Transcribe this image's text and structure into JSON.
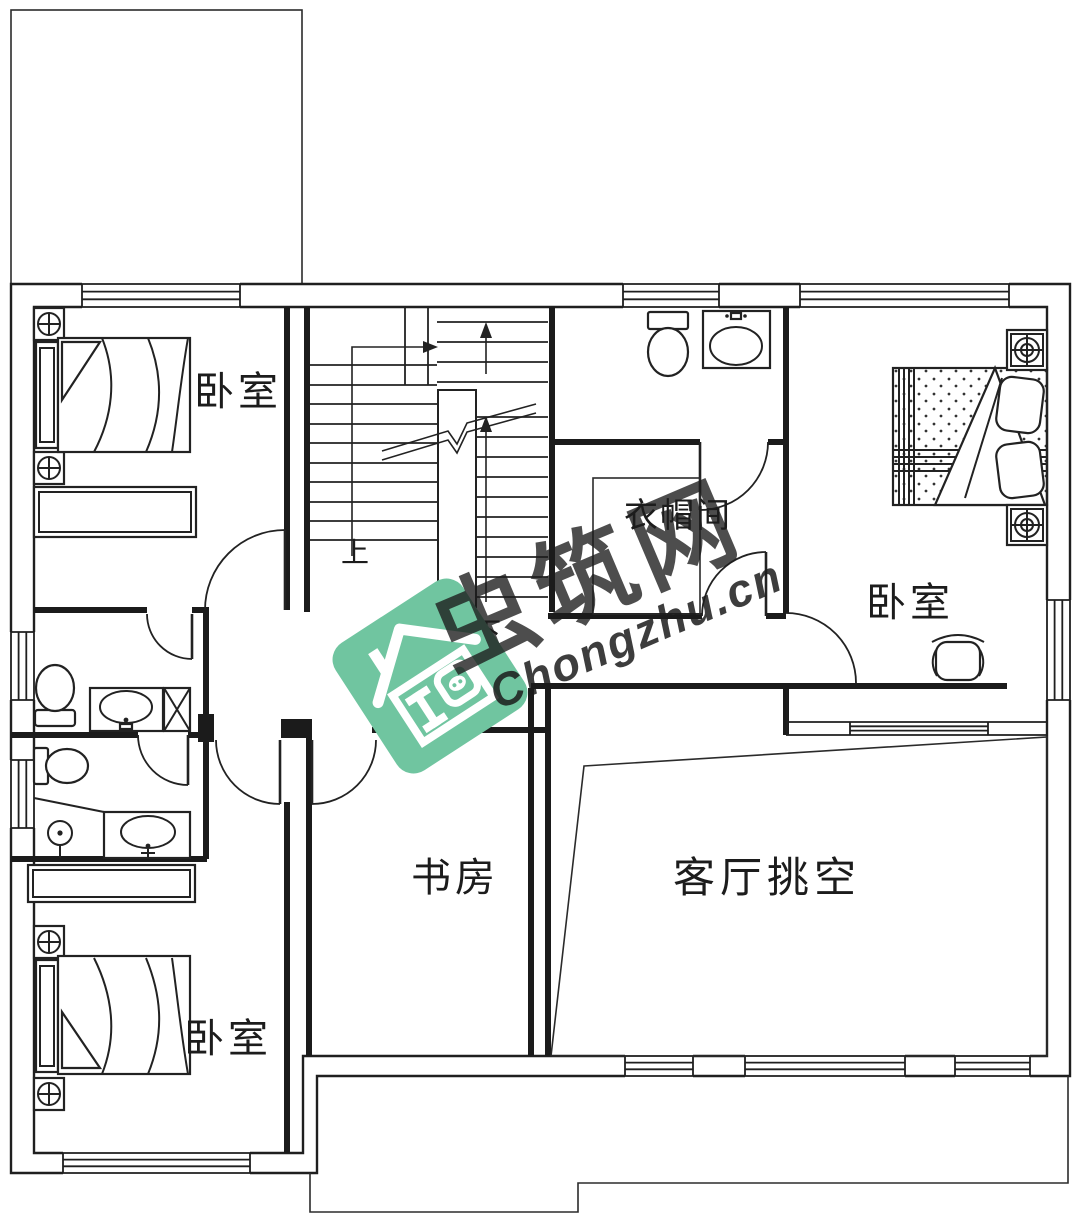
{
  "labels": {
    "bedroom_top_left": "卧室",
    "bedroom_master": "卧室",
    "bedroom_bottom_left": "卧室",
    "closet": "衣帽间",
    "study": "书房",
    "living_void": "客厅挑空",
    "stair_up": "上",
    "stair_down": "下",
    "watermark_cn": "虫筑网",
    "watermark_url": "Chongzhu.cn"
  },
  "colors": {
    "line": "#1f1f1f",
    "watermark_green": "#70c5a0",
    "watermark_gray": "#8d8d8d",
    "background": "#ffffff"
  }
}
